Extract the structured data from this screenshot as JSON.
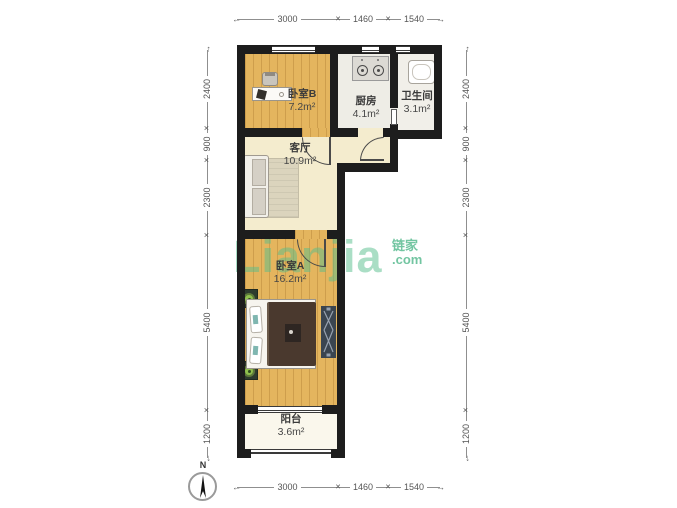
{
  "watermark": {
    "brand": "Lianjia",
    "cn": "链家",
    "tld": ".com"
  },
  "compass": {
    "north": "N"
  },
  "rooms": [
    {
      "name": "卧室B",
      "area": "7.2m²"
    },
    {
      "name": "厨房",
      "area": "4.1m²"
    },
    {
      "name": "卫生间",
      "area": "3.1m²"
    },
    {
      "name": "客厅",
      "area": "10.9m²"
    },
    {
      "name": "卧室A",
      "area": "16.2m²"
    },
    {
      "name": "阳台",
      "area": "3.6m²"
    }
  ],
  "dimensions": {
    "top": [
      "3000",
      "1460",
      "1540"
    ],
    "bottom": [
      "3000",
      "1460",
      "1540"
    ],
    "left": [
      "2400",
      "900",
      "2300",
      "5400",
      "1200"
    ],
    "right": [
      "2400",
      "900",
      "2300",
      "5400",
      "1200"
    ]
  },
  "colors": {
    "wall": "#1d1d1d",
    "wood_floor": "#e4b55e",
    "cream_floor": "#f4ecce",
    "watermark_green": "#55be8c"
  }
}
